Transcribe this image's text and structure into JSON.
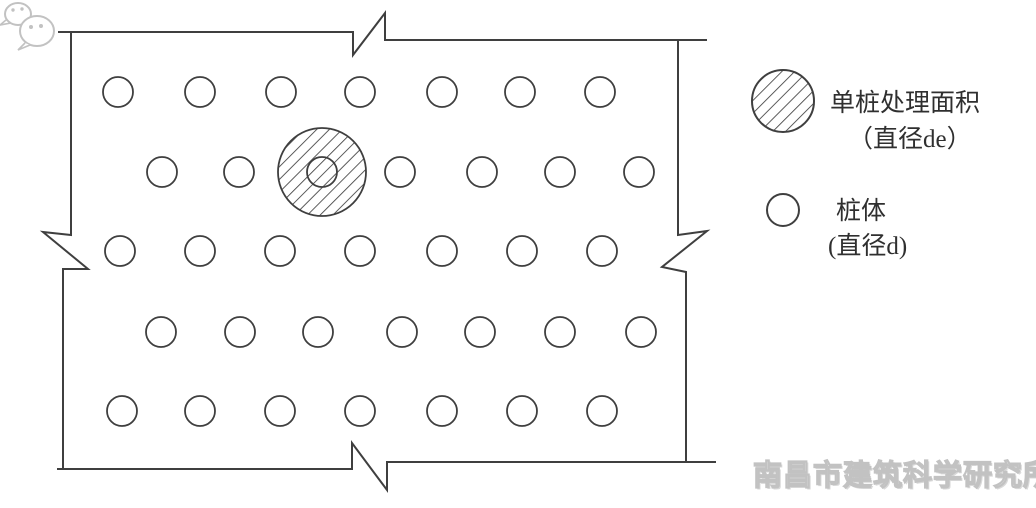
{
  "meta": {
    "background": "#ffffff",
    "line_color": "#3f3f3f",
    "watermark_color": "#c2c2c2"
  },
  "diagram": {
    "description": "pile-layout-plan-with-break-line-border",
    "piles": {
      "radius": 15,
      "rows": [
        {
          "y": 92,
          "x": [
            118,
            200,
            281,
            360,
            442,
            520,
            600
          ]
        },
        {
          "y": 172,
          "x": [
            162,
            239,
            400,
            482,
            560,
            639
          ]
        },
        {
          "y": 251,
          "x": [
            120,
            200,
            280,
            360,
            442,
            522,
            602
          ]
        },
        {
          "y": 332,
          "x": [
            161,
            240,
            318,
            402,
            480,
            560,
            641
          ]
        },
        {
          "y": 411,
          "x": [
            122,
            200,
            280,
            360,
            442,
            522,
            602
          ]
        }
      ]
    },
    "treatment_circle": {
      "cx": 322,
      "cy": 172,
      "outer_r": 44,
      "inner_r": 15
    }
  },
  "legend": {
    "items": [
      {
        "symbol": "hatched-circle",
        "line1": "单桩处理面积",
        "line2": "（直径de）"
      },
      {
        "symbol": "open-circle",
        "line1": "桩体",
        "line2": "(直径d)"
      }
    ],
    "symbol1": {
      "cx": 783,
      "cy": 101,
      "r": 31
    },
    "symbol2": {
      "cx": 783,
      "cy": 210,
      "r": 16
    }
  },
  "watermark": {
    "icon": "wechat-icon",
    "text": "南昌市建筑科学研究所"
  }
}
